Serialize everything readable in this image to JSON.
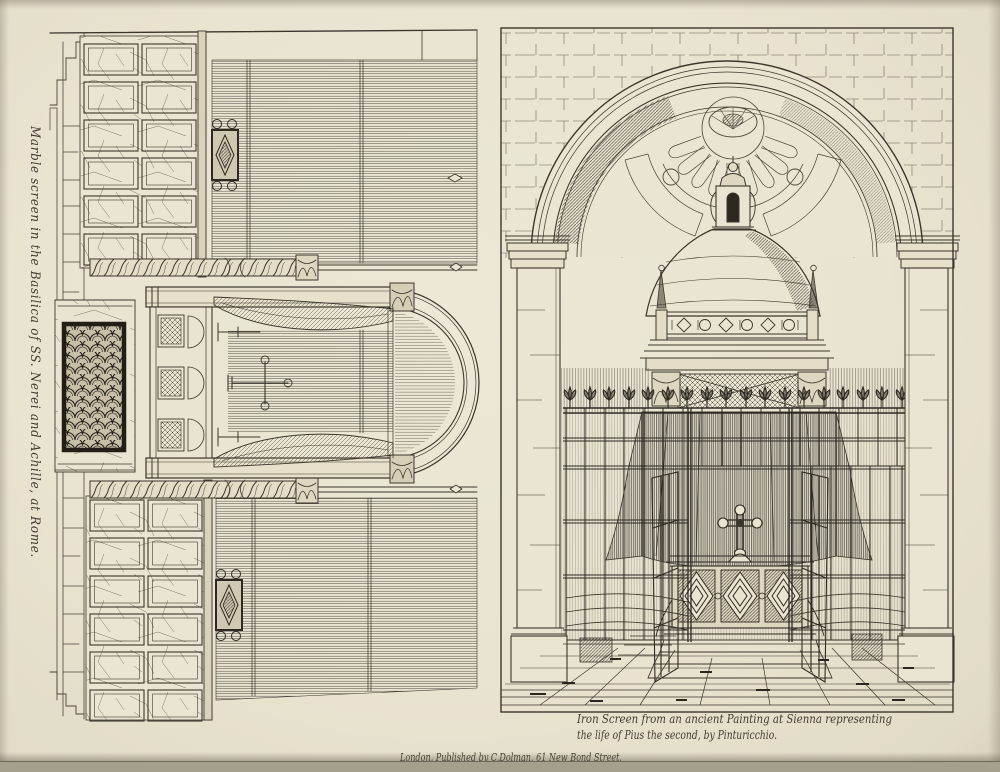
{
  "plate": {
    "paper_color": "#e9e4d1",
    "ink_color": "#3a362c",
    "left_engraving": {
      "title": "Marble screen in the Basilica of SS. Nerei and Achille, at Rome."
    },
    "right_engraving": {
      "caption_line1": "Iron Screen from an ancient Painting at Sienna representing",
      "caption_line2": "the life of Pius the second, by Pinturicchio."
    },
    "imprint": "London, Published by C.Dolman, 61 New Bond Street."
  }
}
